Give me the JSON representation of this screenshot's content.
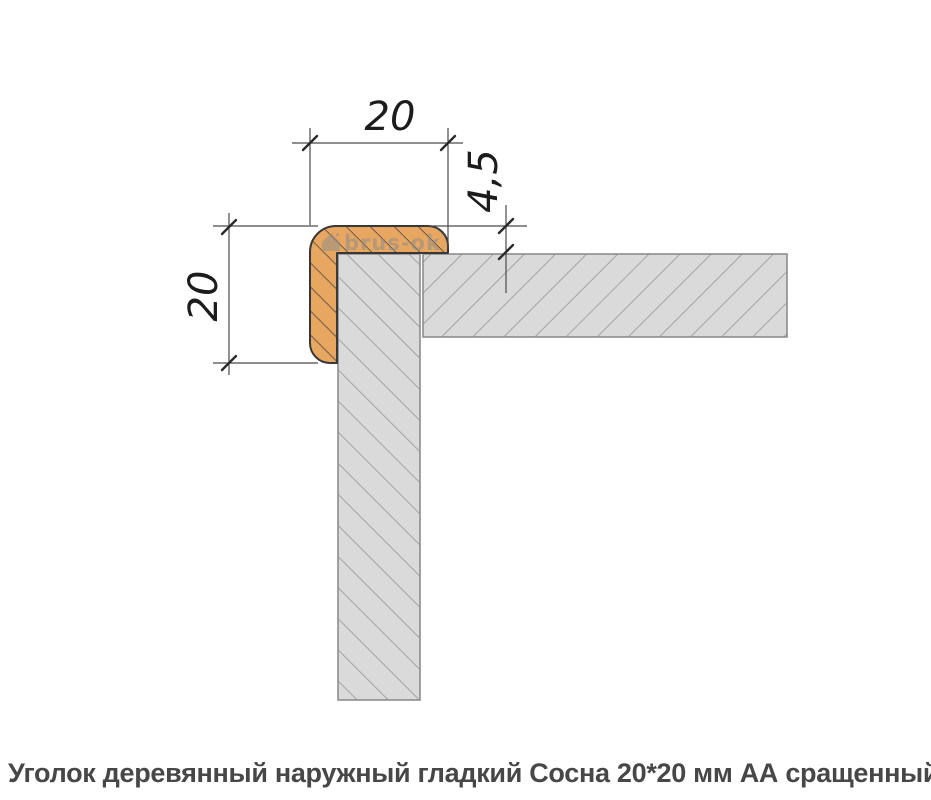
{
  "drawing": {
    "title": "wooden corner profile cross-section",
    "dim_width_label": "20",
    "dim_height_label": "20",
    "dim_lip_label": "4,5",
    "watermark_text": "brus-ok",
    "colors": {
      "wood_fill": "#e8a761",
      "wood_outline": "#383838",
      "wood_hatch": "#3f3f3f",
      "wall_fill": "#dadada",
      "wall_hatch": "#9c9c9c",
      "wall_border": "#8d8d8d",
      "dim_line": "#4a4a4a",
      "dim_tick": "#2a2a2a",
      "dim_text": "#1c1c1c",
      "watermark": "#8c8c8c"
    }
  },
  "caption": {
    "text": "Уголок деревянный наружный гладкий Сосна 20*20 мм АА сращенный"
  }
}
